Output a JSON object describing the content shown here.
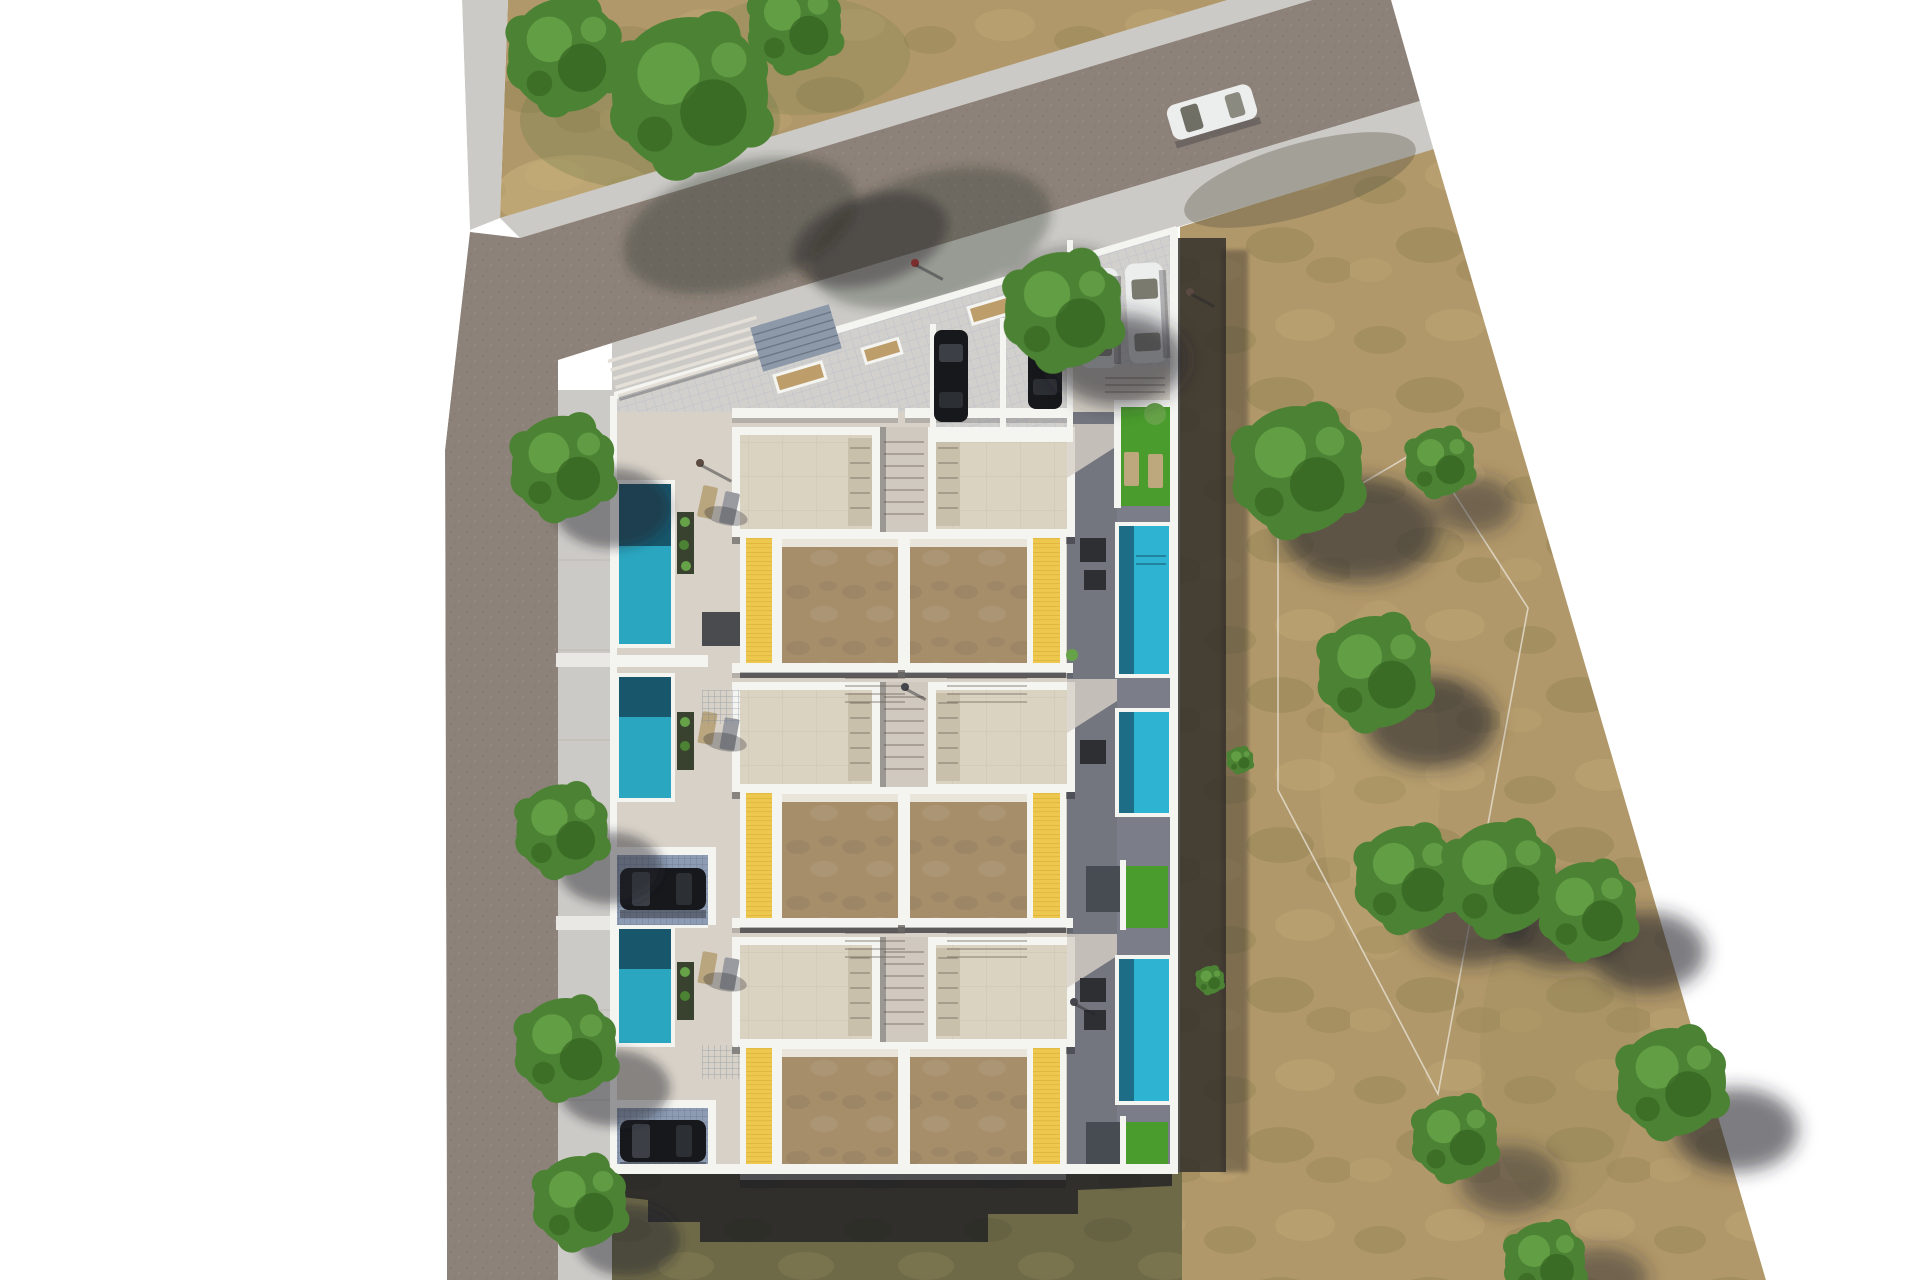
{
  "scene": {
    "kind": "aerial top-down 3D architectural site plan rendering",
    "subject": "residential development of six row villas with private pools, roof terraces, parking forecourt, corner street and dry field",
    "lighting": "hard sunlight from north-west, long shadows cast to south-east",
    "background": "white page, plan floats on blank canvas"
  },
  "palette": {
    "page": "#ffffff",
    "road": "#8d8279",
    "sidewalk": "#cccac6",
    "pavement": "#d7d1c7",
    "pavement2": "#cfc9bf",
    "terrace-shade": "#74767f",
    "terrace-shade2": "#7b7e88",
    "tile-court": "#c9cdd7",
    "carport-tile": "#8d9cb2",
    "wall": "#f4f4f1",
    "roof-stone": "#dbd3c2",
    "roof-stone-dark": "#c9c0ac",
    "roof-brown": "#a78e6b",
    "roof-band": "#e9e5db",
    "deck-yellow": "#eec84e",
    "pool-dark": "#17566b",
    "pool-teal": "#2aa6c0",
    "pool-bright": "#2fb3d2",
    "grass-dry": "#b1986a",
    "grass-olive": "#6e6a48",
    "grass-green": "#4a9c2d",
    "tree": "#4c8234",
    "tree-light": "#66a348",
    "tree-dark": "#33621f",
    "car-dark": "#17181c",
    "car-white": "#eceded"
  },
  "inventory": {
    "villa_units": 6,
    "unit_rows": 3,
    "pools_left_column": 3,
    "pools_right_column": 3,
    "carports_with_cars": 2,
    "dark_cars_forecourt": 2,
    "white_cars_parked": 2,
    "white_cars_driving": 1,
    "solar_grate_panels": 1,
    "planter_boxes_forecourt": 3,
    "lawn_patches": 3,
    "street_trees": 7,
    "field_trees": 11,
    "pedestrians": 5
  }
}
